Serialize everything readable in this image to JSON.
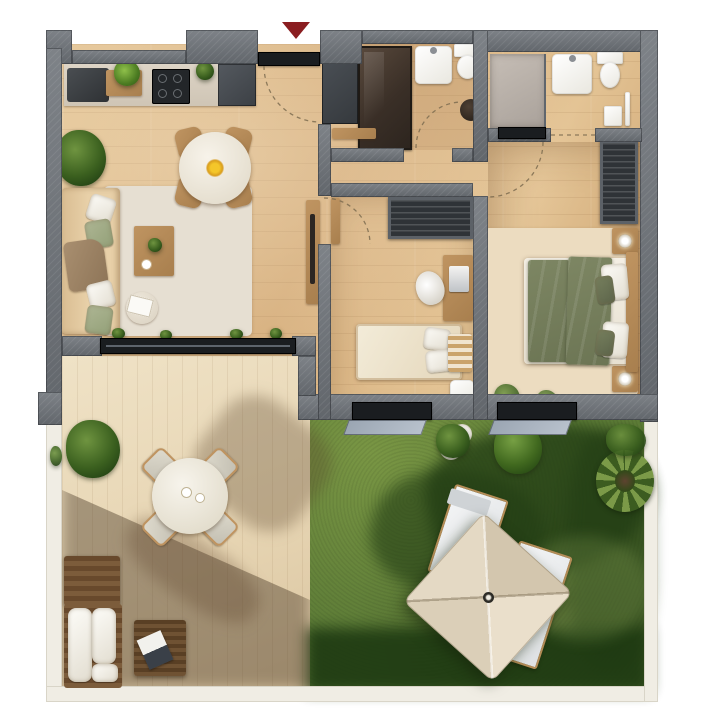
{
  "scene": {
    "type": "top-down 3D architectural floor plan render",
    "subject": "two-bedroom apartment with entrance hall, two bathrooms, terrace and private garden",
    "entrance_marker": "red triangle arrow pointing down at the front door"
  },
  "colors": {
    "wall": "#6f747a",
    "darkSlab": "#1a1d20",
    "floor": "#d6ae7c",
    "floorLight": "#e4c495",
    "floorDeep": "#c89e6b",
    "deck": "#e7d5b3",
    "deckLight": "#efe2c6",
    "deckDeep": "#d9c4a0",
    "grass": "#5d7c37",
    "grassLight": "#799644",
    "grassShadow": "#223d14",
    "rug": "#e6dfd2",
    "bedroomRug": "#ecdcc0",
    "sofa": "#e8d0a8",
    "sage": "#aeb694",
    "wood": "#bf9461",
    "duvet": "#6c7554",
    "duvetLight": "#7d8663",
    "glass": "#9aa5b2",
    "frame": "#f0ede4",
    "accentRed": "#8a1d20",
    "parasol": "#e6dbc6"
  },
  "rooms": [
    {
      "name": "kitchen-living-room",
      "items": [
        "kitchen counter",
        "sink unit",
        "cutting board with herbs",
        "cooktop",
        "tall kitchen cabinet",
        "round dining table",
        "dining chairs x4",
        "yellow flower centerpiece",
        "large potted plant",
        "sofa with cushions and throw",
        "area rug",
        "coffee table with plant and cup",
        "round side table with book",
        "wall console",
        "sliding glass door to terrace",
        "windowsill plants"
      ]
    },
    {
      "name": "entrance-hall",
      "items": [
        "front door",
        "entry closet",
        "hall bench"
      ]
    },
    {
      "name": "bathroom-1",
      "items": [
        "walk-in shower (dark glass)",
        "washbasin",
        "toilet",
        "laundry basket",
        "towel rail"
      ]
    },
    {
      "name": "bathroom-2",
      "items": [
        "walk-in shower (light tray)",
        "washbasin",
        "toilet",
        "small cabinet",
        "towel rail"
      ]
    },
    {
      "name": "kids-room",
      "items": [
        "slatted wardrobe",
        "desk with laptop",
        "desk chair",
        "single bed with pillows",
        "plaid blanket",
        "bedside cabinet",
        "window"
      ]
    },
    {
      "name": "master-bedroom",
      "items": [
        "slatted wardrobe",
        "double bed with olive duvet",
        "pillows",
        "headboard",
        "nightstand with lamp x2",
        "bedroom rug",
        "floor plants",
        "window"
      ]
    },
    {
      "name": "terrace",
      "items": [
        "wood decking",
        "potted plant",
        "round outdoor table",
        "outdoor chairs x4",
        "outdoor sofa with white cushions",
        "wooden bench",
        "slatted side table with magazine"
      ]
    },
    {
      "name": "garden",
      "items": [
        "lawn",
        "planter pots with plants",
        "leafy shrub",
        "agave plants x2",
        "sun loungers x2",
        "square parasol",
        "tree shadows",
        "white plot border"
      ]
    }
  ]
}
